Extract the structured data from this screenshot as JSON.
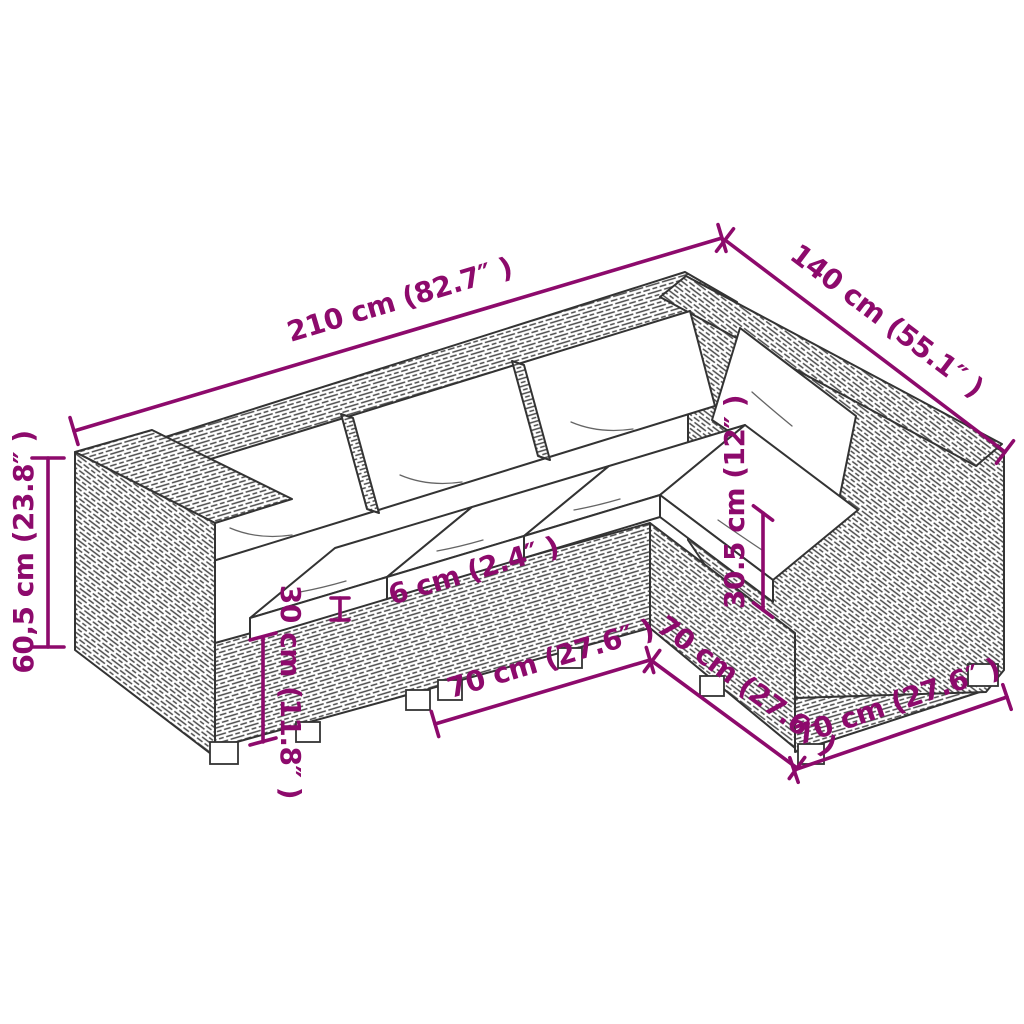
{
  "diagram": {
    "type": "product-dimension-diagram",
    "subject": "L-shaped poly rattan garden lounge set with white cushions (3-seat row plus corner wing)",
    "colors": {
      "dimension": "#8D0A6C",
      "line_art": "#333333",
      "background": "#FFFFFF",
      "cushion": "#FFFFFF"
    },
    "dimensions": [
      {
        "id": "main-length",
        "label": "210 cm (82.7″ )"
      },
      {
        "id": "wing-length",
        "label": "140 cm (55.1″ )"
      },
      {
        "id": "total-height",
        "label": "60,5 cm (23.8″ )"
      },
      {
        "id": "base-height",
        "label": "30 cm (11.8″ )"
      },
      {
        "id": "cushion-thickness",
        "label": "6 cm (2.4″ )"
      },
      {
        "id": "backrest-height",
        "label": "30.5 cm (12″ )"
      },
      {
        "id": "module-width-front",
        "label": "70 cm (27.6″ )"
      },
      {
        "id": "module-width-side",
        "label": "70 cm (27.6″ )"
      },
      {
        "id": "module-width-end",
        "label": "70 cm (27.6″ )"
      }
    ]
  }
}
